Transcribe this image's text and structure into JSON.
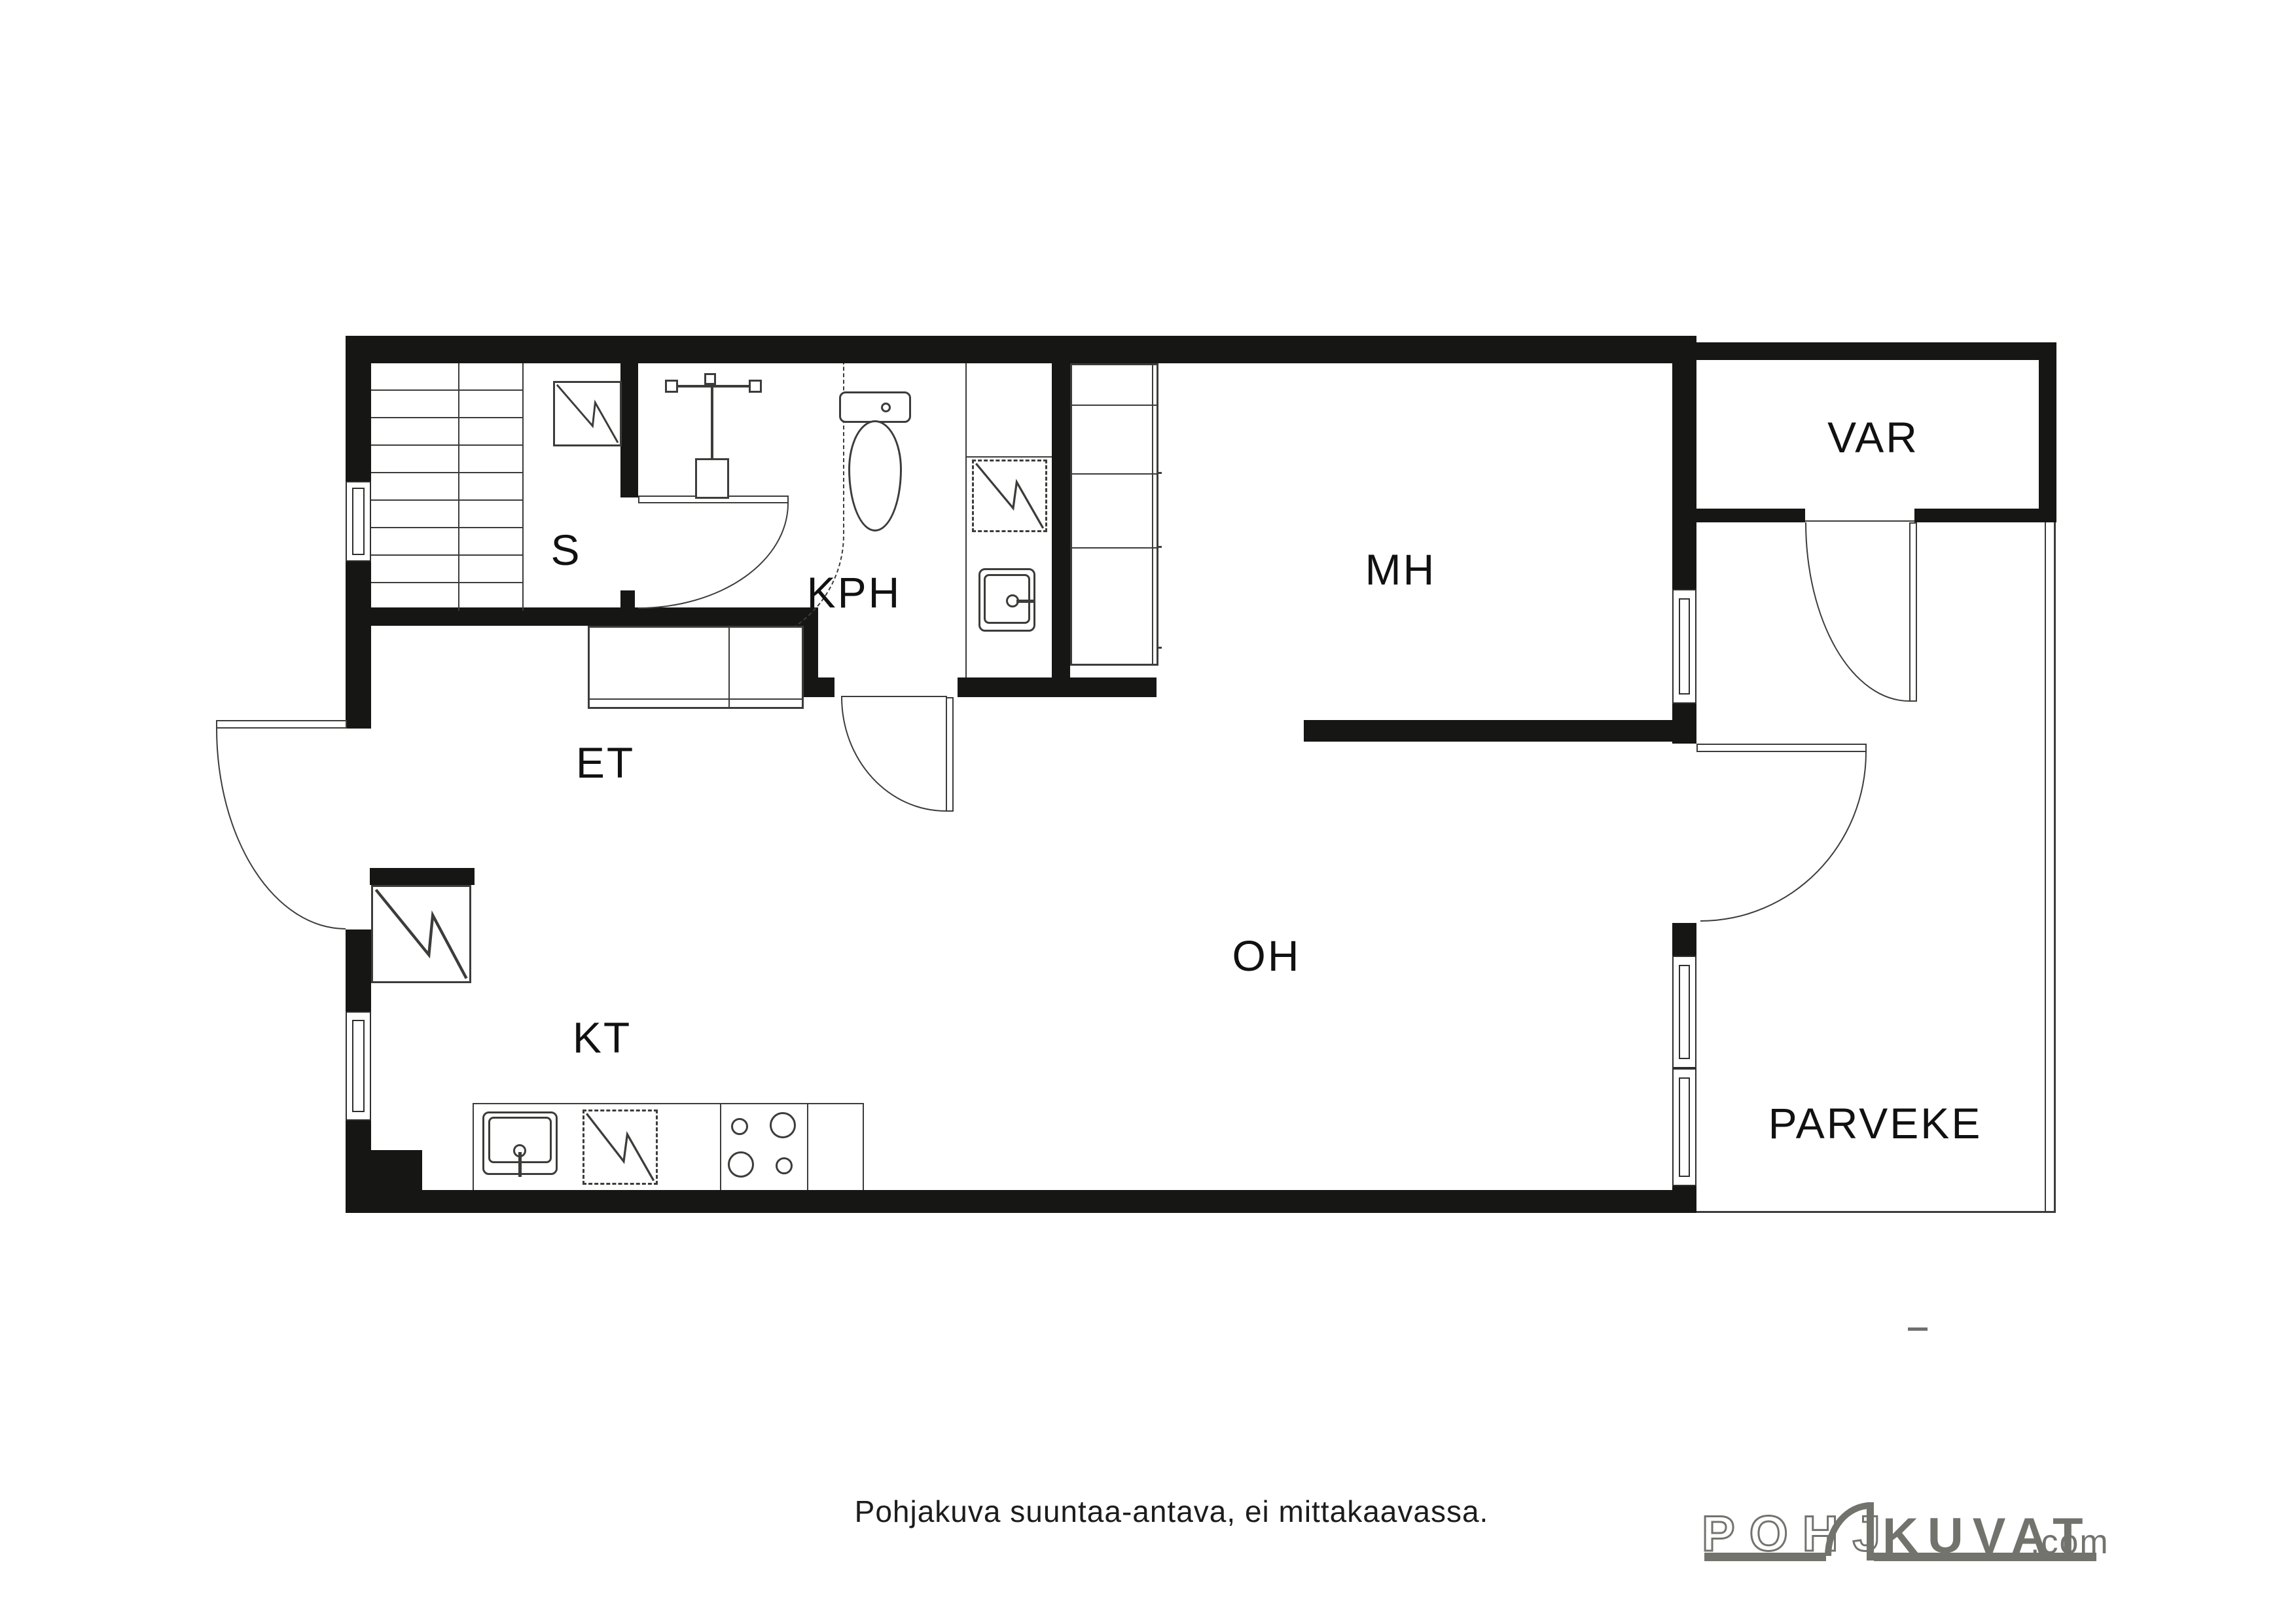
{
  "meta": {
    "type": "floorplan",
    "caption": "Pohjakuva suuntaa-antava, ei mittakaavassa.",
    "colors": {
      "wall": "#161614",
      "line": "#3c3c3a",
      "logo": "#73736e",
      "background": "#ffffff"
    }
  },
  "rooms": {
    "sauna": {
      "label": "S"
    },
    "bathroom": {
      "label": "KPH"
    },
    "bedroom": {
      "label": "MH"
    },
    "storage": {
      "label": "VAR"
    },
    "entry": {
      "label": "ET"
    },
    "kitchen": {
      "label": "KT"
    },
    "living": {
      "label": "OH"
    },
    "balcony": {
      "label": "PARVEKE"
    }
  },
  "fixtures": [
    "stairs",
    "sauna-stove",
    "shower",
    "toilet",
    "washing-machine",
    "bathroom-sink",
    "wardrobe-et",
    "wardrobe-mh",
    "fridge",
    "kitchen-sink",
    "dishwasher",
    "stove-4-burner",
    "kitchen-counter"
  ],
  "logo": {
    "pohj": "POHJ",
    "kuvat": "KUVAT",
    "com": ".com"
  }
}
